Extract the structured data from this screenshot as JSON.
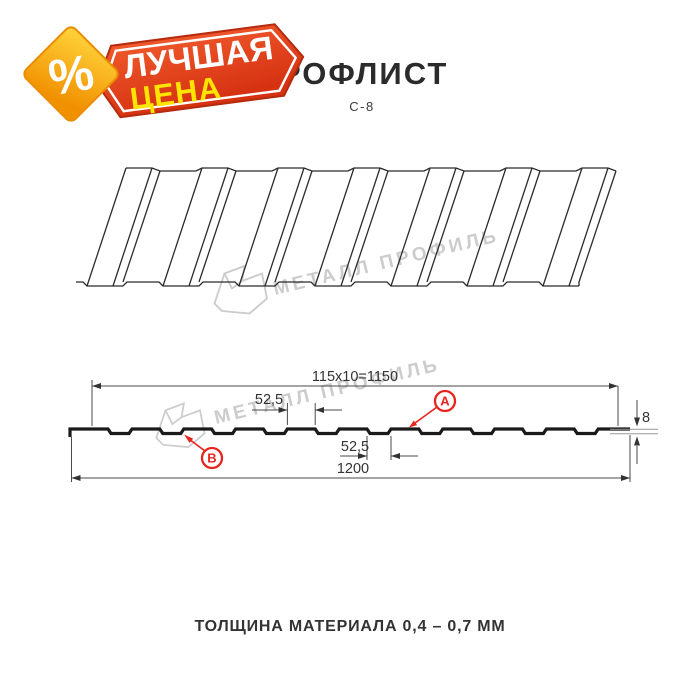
{
  "header": {
    "title": "ПРОФЛИСТ",
    "subtitle": "С-8"
  },
  "badge": {
    "percent_symbol": "%",
    "line1": "ЛУЧШАЯ",
    "line2": "ЦЕНА"
  },
  "watermark": {
    "brand": "МЕТАЛЛ ПРОФИЛЬ"
  },
  "cross_section": {
    "working_width": "115x10=1150",
    "rib_width_top": "52,5",
    "rib_width_bottom": "52,5",
    "overall_width": "1200",
    "profile_height": "8",
    "face_label_a": "A",
    "face_label_b": "B"
  },
  "footer": {
    "material_note": "ТОЛЩИНА МАТЕРИАЛА 0,4 – 0,7 ММ"
  },
  "colors": {
    "badge_red": "#e04218",
    "badge_red_dark": "#b52b0e",
    "badge_yellow_text": "#ffe400",
    "diamond_orange": "#f19000",
    "diamond_yellow": "#ffd53d",
    "accent_red": "#e8251d",
    "text_dark": "#2b2b2b",
    "watermark_gray": "#cccccc"
  }
}
